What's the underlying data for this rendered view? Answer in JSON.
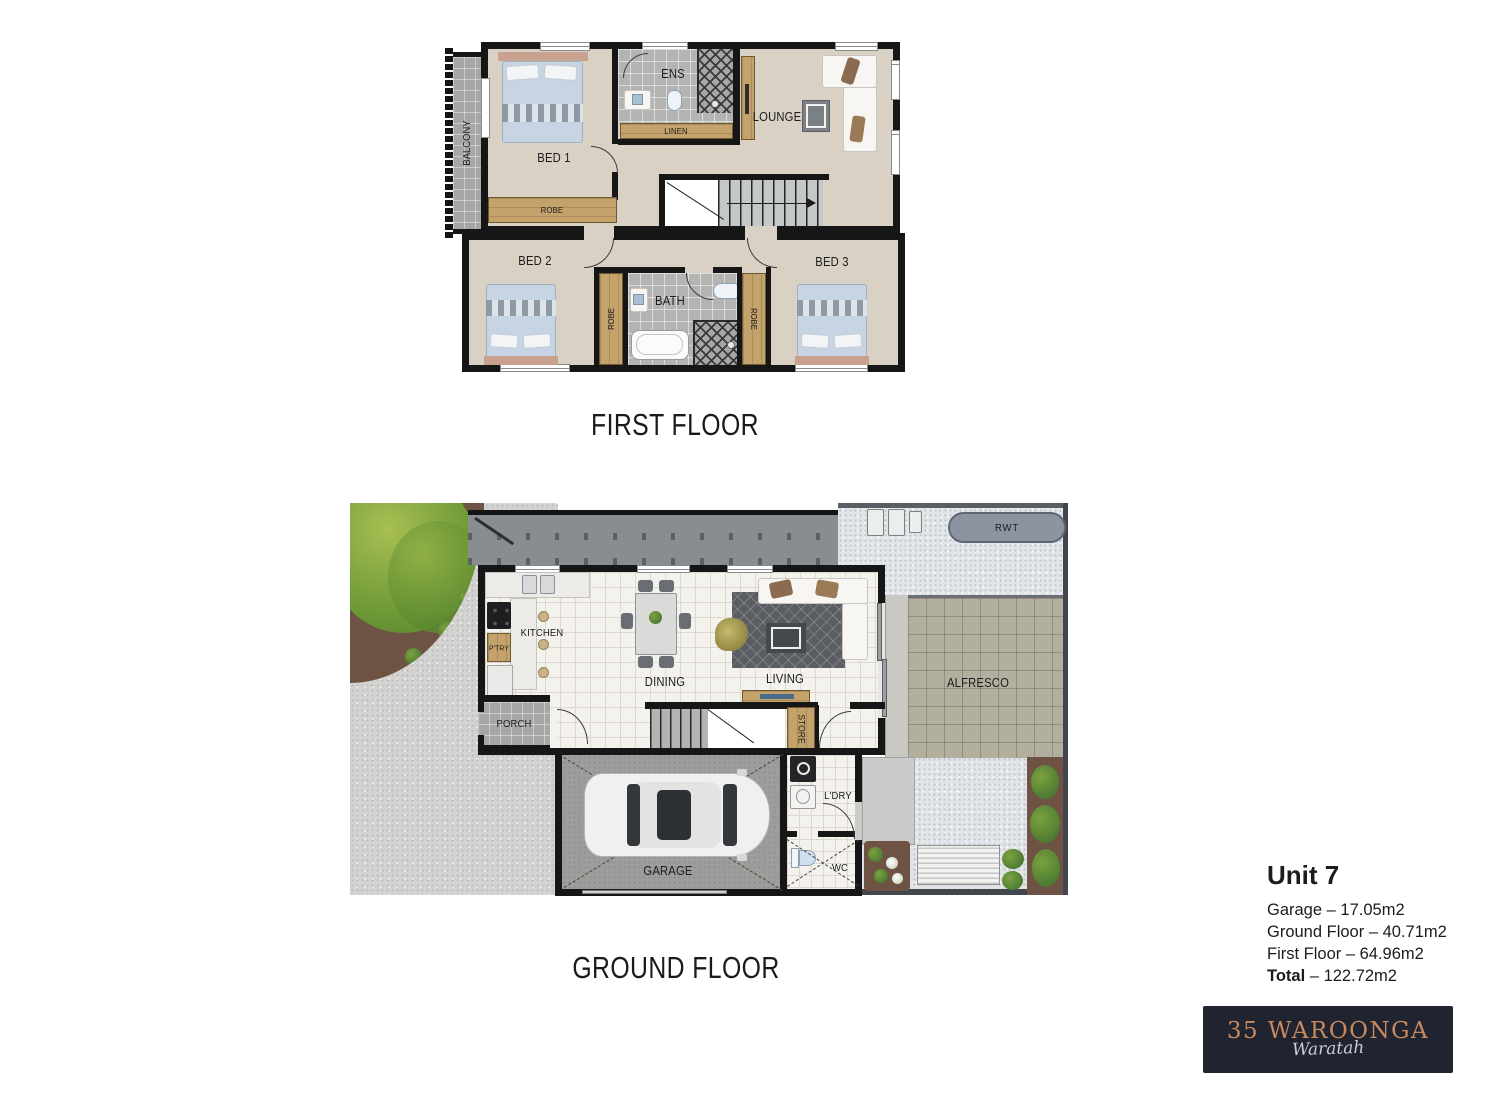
{
  "first_floor": {
    "title": "FIRST FLOOR",
    "labels": {
      "balcony": "BALCONY",
      "bed1": "BED 1",
      "robe_bed1": "ROBE",
      "ens": "ENS",
      "linen": "LINEN",
      "lounge": "LOUNGE",
      "bed2": "BED 2",
      "robe_left": "ROBE",
      "bath": "BATH",
      "robe_right": "ROBE",
      "bed3": "BED 3"
    }
  },
  "ground_floor": {
    "title": "GROUND FLOOR",
    "labels": {
      "rwt": "RWT",
      "kitchen": "KITCHEN",
      "pantry": "P'TRY",
      "dining": "DINING",
      "living": "LIVING",
      "alfresco": "ALFRESCO",
      "porch": "PORCH",
      "store": "STORE",
      "garage": "GARAGE",
      "laundry": "L'DRY",
      "wc": "WC"
    }
  },
  "unit_info": {
    "title": "Unit 7",
    "separator": "–",
    "areas": [
      {
        "label": "Garage",
        "value": "17.05m2"
      },
      {
        "label": "Ground Floor",
        "value": "40.71m2"
      },
      {
        "label": "First Floor",
        "value": "64.96m2"
      },
      {
        "label": "Total",
        "value": "122.72m2"
      }
    ]
  },
  "logo": {
    "title": "35 WAROONGA",
    "subtitle": "Waratah"
  },
  "palette": {
    "wall": "#161616",
    "floor_beige": "#d9d1c4",
    "joinery_wood": "#c3a26b",
    "tile_gray": "#b4b4b2",
    "logo_background": "#1f2430",
    "logo_accent": "#c9895d"
  }
}
